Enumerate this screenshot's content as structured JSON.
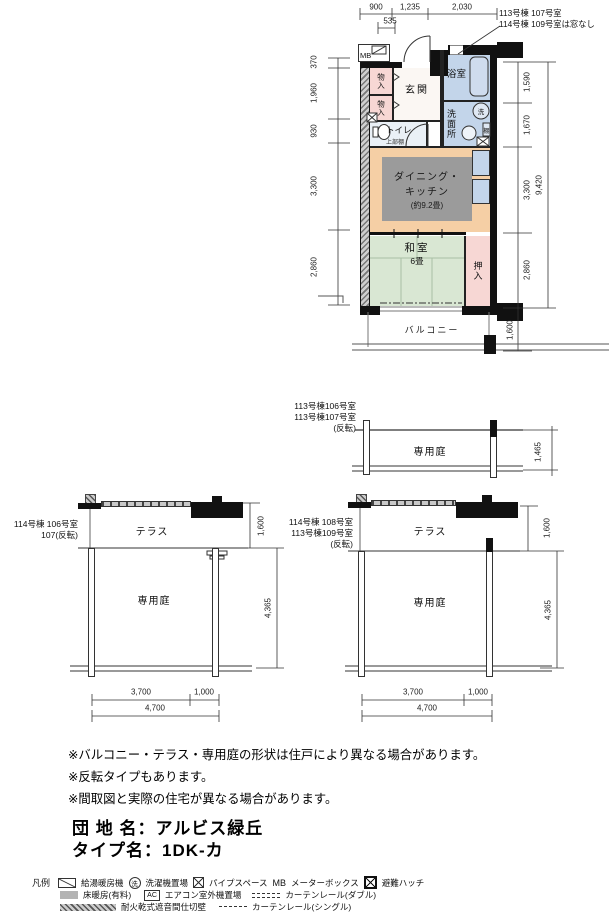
{
  "plan": {
    "dims": {
      "top": [
        "900",
        "1,235",
        "2,030"
      ],
      "top_sub": "535",
      "left": [
        "370",
        "1,960",
        "930",
        "3,300",
        "2,860"
      ],
      "right": [
        "1,590",
        "1,670",
        "3,300",
        "2,860"
      ],
      "right_total": "9,420",
      "balcony": "1,600"
    },
    "note_line1": "113号棟 107号室",
    "note_line2": "114号棟 109号室は窓なし",
    "labels": {
      "mb": "MB",
      "entrance": "玄関",
      "bath": "浴室",
      "washroom": "洗面所",
      "storage1": "物入",
      "storage2": "物入",
      "toilet": "トイレ",
      "toilet_shelf": "上部棚",
      "shelf": "棚",
      "washer_symbol": "洗",
      "dk1": "ダイニング・",
      "dk2": "キッチン",
      "dk3": "(約9.2畳)",
      "tatami1": "和室",
      "tatami2": "6畳",
      "closet": "押入",
      "balcony": "バルコニー"
    }
  },
  "garden_a": {
    "label1": "113号棟106号室",
    "label2": "113号棟107号室",
    "label3": "(反転)",
    "area": "専用庭",
    "dim_height": "1,465"
  },
  "terrace_b": {
    "label1": "114号棟 106号室",
    "label2": "107(反転)",
    "terrace": "テラス",
    "garden": "専用庭",
    "dim_terrace": "1,600",
    "dim_garden": "4,365",
    "dim_w1": "3,700",
    "dim_w2": "1,000",
    "dim_w_total": "4,700"
  },
  "terrace_c": {
    "label1": "114号棟 108号室",
    "label2": "113号棟109号室",
    "label3": "(反転)",
    "terrace": "テラス",
    "garden": "専用庭",
    "dim_terrace": "1,600",
    "dim_garden": "4,365",
    "dim_w1": "3,700",
    "dim_w2": "1,000",
    "dim_w_total": "4,700"
  },
  "notes": [
    "※バルコニー・テラス・専用庭の形状は住戸により異なる場合があります。",
    "※反転タイプもあります。",
    "※間取図と実際の住宅が異なる場合があります。"
  ],
  "title": {
    "estate_label": "団 地 名：",
    "estate_value": "アルビス緑丘",
    "type_label": "タイプ名：",
    "type_value": "1DK-カ"
  },
  "legend": {
    "heading": "凡例",
    "water_heater": "給湯暖房機",
    "washer": "洗濯機置場",
    "washer_symbol": "洗",
    "pipe_space": "パイプスペース",
    "mb_symbol": "MB",
    "meter_box": "メーターボックス",
    "escape_hatch": "避難ハッチ",
    "floor_heating": "床暖房(有料)",
    "ac_symbol": "AC",
    "ac_outdoor": "エアコン室外機置場",
    "curtain_double": "カーテンレール(ダブル)",
    "firewall": "耐火乾式遮音間仕切壁",
    "curtain_single": "カーテンレール(シングル)"
  },
  "colors": {
    "wall": "#111111",
    "wet_area": "#c3d5ea",
    "storage_pink": "#f7d7d4",
    "dk_peach": "#f5cfa5",
    "tatami_green": "#d9e7d3",
    "floor_heating_gray": "#9b9b9b"
  }
}
